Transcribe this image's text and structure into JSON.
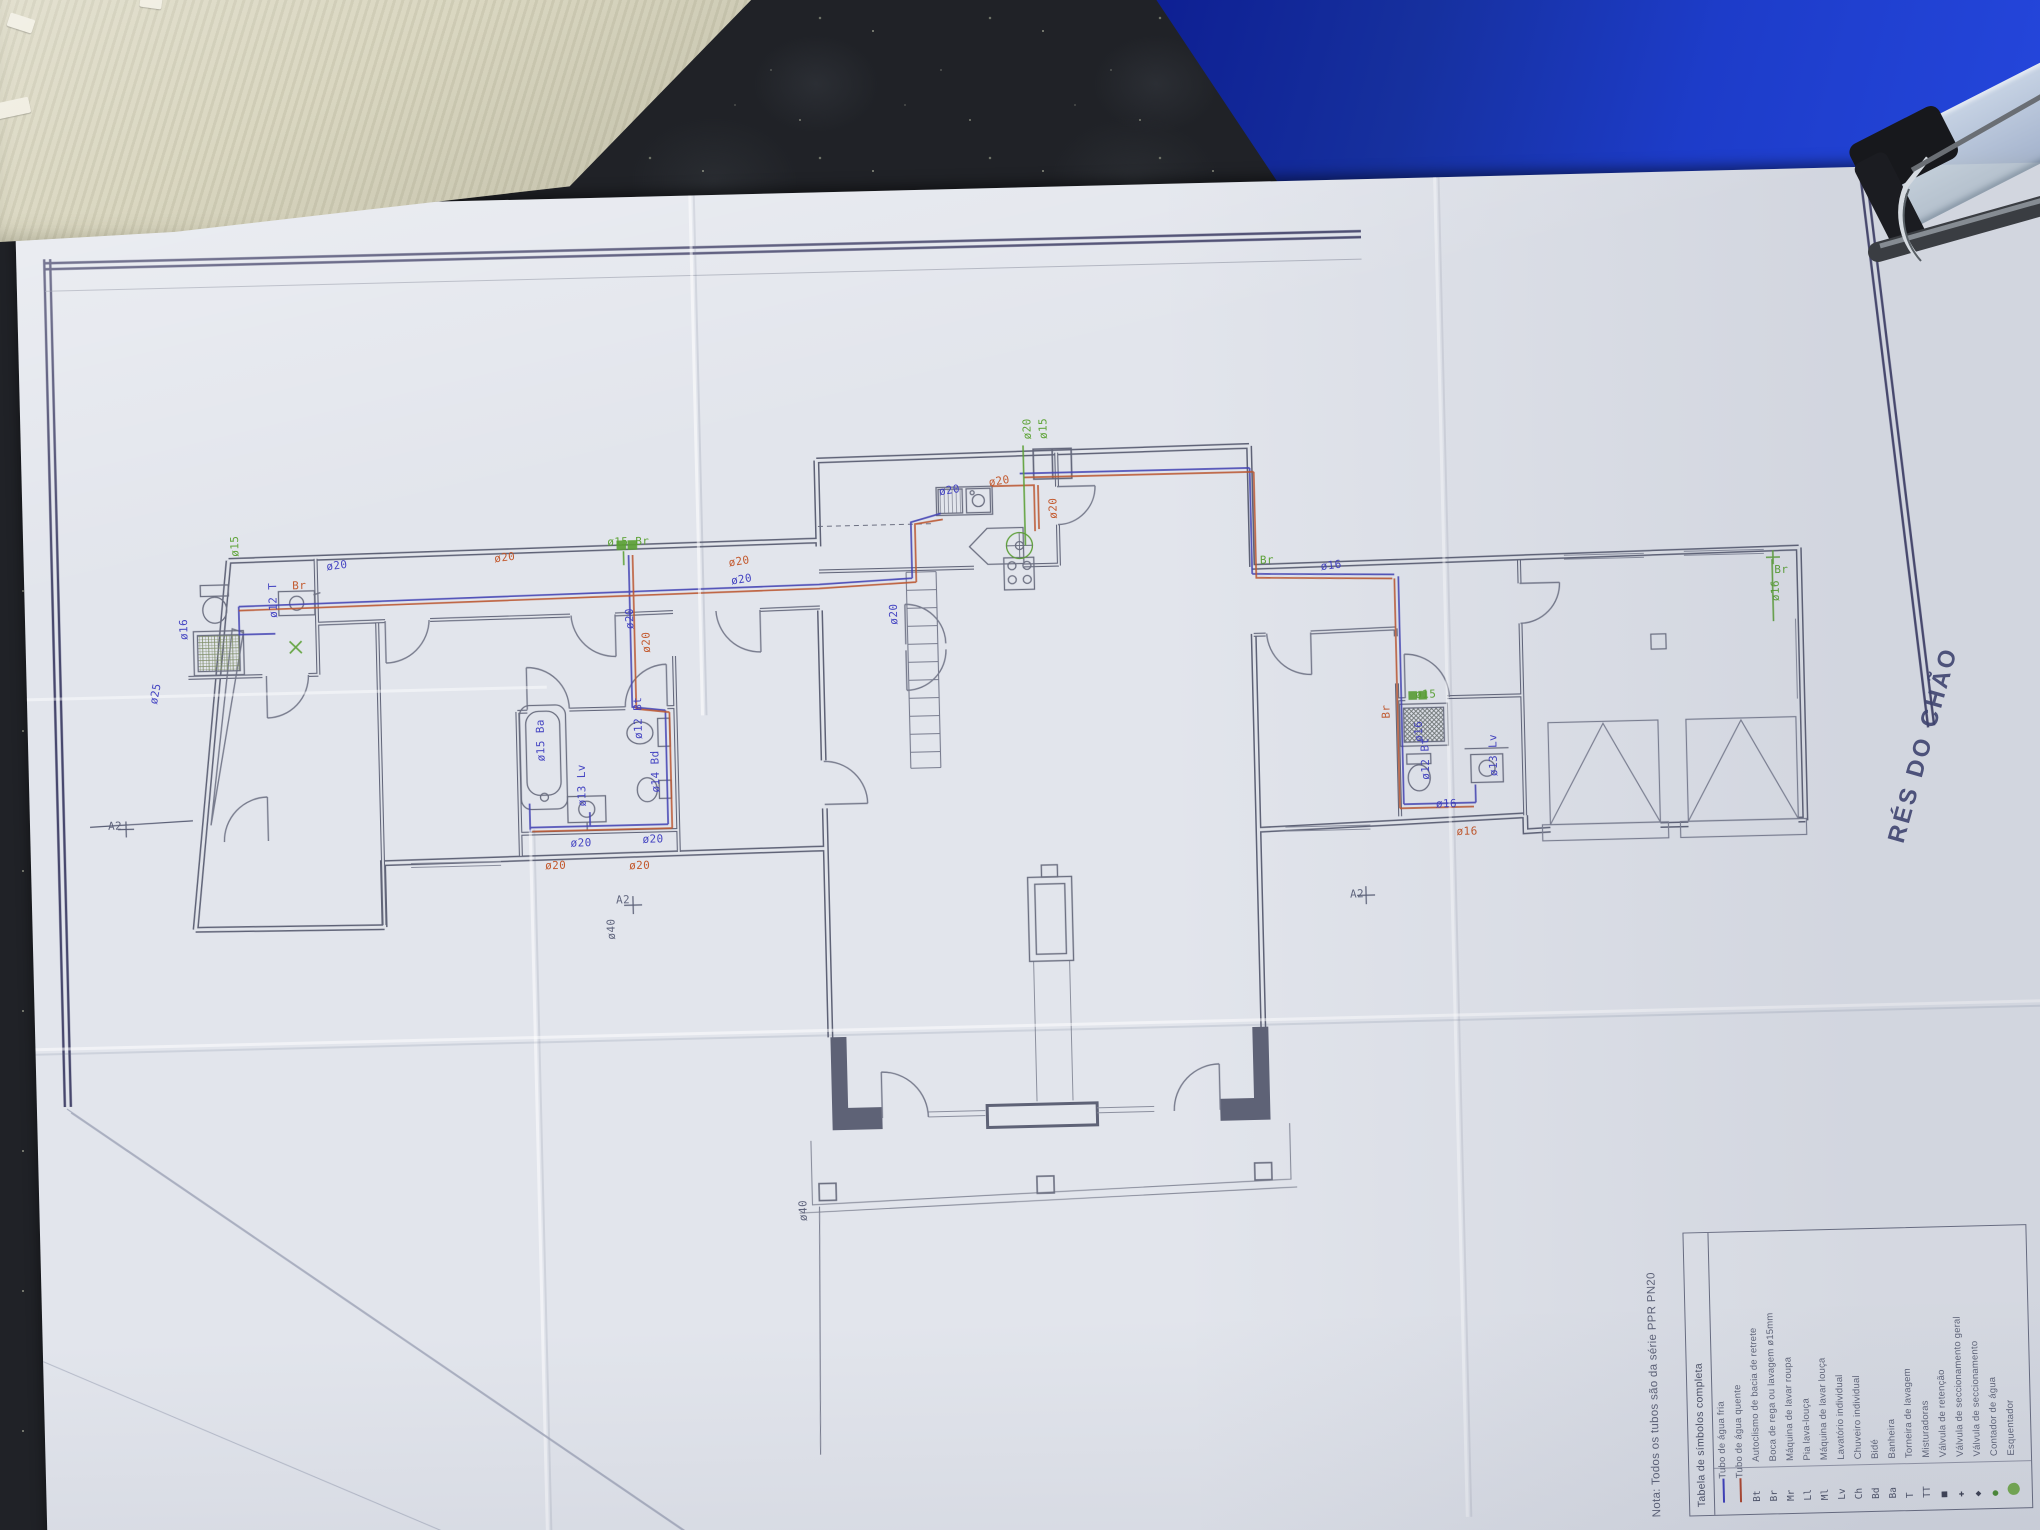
{
  "scene": {
    "floor_label": "RÉS DO CHÃO",
    "note": "Nota:  Todos os tubos são da série PPR PN20"
  },
  "legend": {
    "header": "Tabela de símbolos completa",
    "rows": [
      {
        "sym": "",
        "cls": "sw-cold",
        "desc": "Tubo de água fria"
      },
      {
        "sym": "",
        "cls": "sw-hot",
        "desc": "Tubo de água quente"
      },
      {
        "sym": "Bt",
        "cls": "",
        "desc": "Autoclismo de bacia de retrete"
      },
      {
        "sym": "Br",
        "cls": "",
        "desc": "Boca de rega ou lavagem ø15mm"
      },
      {
        "sym": "Mr",
        "cls": "",
        "desc": "Máquina de lavar roupa"
      },
      {
        "sym": "Ll",
        "cls": "",
        "desc": "Pia lava-louça"
      },
      {
        "sym": "Ml",
        "cls": "",
        "desc": "Máquina de lavar louça"
      },
      {
        "sym": "Lv",
        "cls": "",
        "desc": "Lavatório individual"
      },
      {
        "sym": "Ch",
        "cls": "",
        "desc": "Chuveiro individual"
      },
      {
        "sym": "Bd",
        "cls": "",
        "desc": "Bidé"
      },
      {
        "sym": "Ba",
        "cls": "",
        "desc": "Banheira"
      },
      {
        "sym": "T",
        "cls": "",
        "desc": "Torneira de lavagem"
      },
      {
        "sym": "TT",
        "cls": "",
        "desc": "Misturadoras"
      },
      {
        "sym": "■",
        "cls": "dark",
        "desc": "Válvula de retenção"
      },
      {
        "sym": "✚",
        "cls": "dark",
        "desc": "Válvula de seccionamento geral"
      },
      {
        "sym": "◆",
        "cls": "dark",
        "desc": "Válvula de seccionamento"
      },
      {
        "sym": "●",
        "cls": "grn",
        "desc": "Contador de água"
      },
      {
        "sym": "⬤",
        "cls": "grn2",
        "desc": "Esquentador"
      }
    ]
  },
  "plan_labels": [
    {
      "t": "ø16",
      "x": 152,
      "y": 432,
      "r": -90,
      "c": "b"
    },
    {
      "t": "ø25",
      "x": 120,
      "y": 494,
      "r": -78,
      "c": "b"
    },
    {
      "t": "ø15",
      "x": 205,
      "y": 350,
      "r": -90,
      "c": "g"
    },
    {
      "t": "ø12 T",
      "x": 242,
      "y": 412,
      "r": -90,
      "c": "b"
    },
    {
      "t": "Br",
      "x": 268,
      "y": 374,
      "r": 0,
      "c": "r"
    },
    {
      "t": "ø20",
      "x": 302,
      "y": 356,
      "r": -6,
      "c": "b"
    },
    {
      "t": "ø20",
      "x": 470,
      "y": 352,
      "r": -6,
      "c": "r"
    },
    {
      "t": "ø20",
      "x": 598,
      "y": 432,
      "r": -90,
      "c": "b"
    },
    {
      "t": "ø20",
      "x": 614,
      "y": 456,
      "r": -90,
      "c": "r"
    },
    {
      "t": "ø15 Br",
      "x": 584,
      "y": 338,
      "r": 0,
      "c": "g"
    },
    {
      "t": "ø20",
      "x": 704,
      "y": 362,
      "r": -8,
      "c": "r"
    },
    {
      "t": "ø20",
      "x": 706,
      "y": 380,
      "r": -8,
      "c": "b"
    },
    {
      "t": "ø20",
      "x": 862,
      "y": 434,
      "r": -90,
      "c": "b"
    },
    {
      "t": "ø20",
      "x": 966,
      "y": 288,
      "r": -8,
      "c": "r"
    },
    {
      "t": "ø20",
      "x": 916,
      "y": 296,
      "r": -8,
      "c": "b"
    },
    {
      "t": "ø20",
      "x": 1000,
      "y": 252,
      "r": -90,
      "c": "g"
    },
    {
      "t": "ø15",
      "x": 1016,
      "y": 252,
      "r": -90,
      "c": "g"
    },
    {
      "t": "ø20",
      "x": 1024,
      "y": 332,
      "r": -90,
      "c": "r"
    },
    {
      "t": "ø15 Ba",
      "x": 506,
      "y": 562,
      "r": -90,
      "c": "b"
    },
    {
      "t": "ø12 Bt",
      "x": 604,
      "y": 542,
      "r": -90,
      "c": "b"
    },
    {
      "t": "ø14 Bd",
      "x": 620,
      "y": 596,
      "r": -90,
      "c": "b"
    },
    {
      "t": "ø13 Lv",
      "x": 546,
      "y": 608,
      "r": -90,
      "c": "b"
    },
    {
      "t": "ø20",
      "x": 540,
      "y": 638,
      "r": 0,
      "c": "b"
    },
    {
      "t": "ø20",
      "x": 514,
      "y": 660,
      "r": 0,
      "c": "r"
    },
    {
      "t": "ø20",
      "x": 612,
      "y": 636,
      "r": 0,
      "c": "b"
    },
    {
      "t": "ø20",
      "x": 598,
      "y": 662,
      "r": 0,
      "c": "r"
    },
    {
      "t": "ø16",
      "x": 1296,
      "y": 380,
      "r": -6,
      "c": "b"
    },
    {
      "t": "Br",
      "x": 1236,
      "y": 372,
      "r": 0,
      "c": "g"
    },
    {
      "t": "Br",
      "x": 1352,
      "y": 540,
      "r": -90,
      "c": "r"
    },
    {
      "t": "ø16",
      "x": 1384,
      "y": 564,
      "r": -90,
      "c": "b"
    },
    {
      "t": "ø15",
      "x": 1388,
      "y": 510,
      "r": 0,
      "c": "g"
    },
    {
      "t": "ø12 Bt",
      "x": 1390,
      "y": 602,
      "r": -90,
      "c": "b"
    },
    {
      "t": "ø13 Lv",
      "x": 1458,
      "y": 600,
      "r": -90,
      "c": "b"
    },
    {
      "t": "ø16",
      "x": 1406,
      "y": 620,
      "r": 0,
      "c": "b"
    },
    {
      "t": "ø16",
      "x": 1426,
      "y": 648,
      "r": 0,
      "c": "r"
    },
    {
      "t": "ø16",
      "x": 1744,
      "y": 432,
      "r": -90,
      "c": "g"
    },
    {
      "t": "Br",
      "x": 1750,
      "y": 394,
      "r": 0,
      "c": "g"
    },
    {
      "t": "ø40",
      "x": 572,
      "y": 742,
      "r": -90,
      "c": "n"
    },
    {
      "t": "ø40",
      "x": 757,
      "y": 1028,
      "r": -90,
      "c": "n"
    },
    {
      "t": "A2",
      "x": 584,
      "y": 696,
      "r": 0,
      "c": "n"
    },
    {
      "t": "A2",
      "x": 1318,
      "y": 708,
      "r": 0,
      "c": "n"
    },
    {
      "t": "A2",
      "x": 78,
      "y": 610,
      "r": 0,
      "c": "n"
    }
  ],
  "colors": {
    "cold_pipe": "#3d3dc0",
    "hot_pipe": "#c25325",
    "irrigation": "#57a02e",
    "wall": "#5e6278",
    "frame": "#2b2b5a",
    "paper": "#e2e5ec",
    "folder_blue": "#1d3cc9",
    "table": "#202227"
  }
}
